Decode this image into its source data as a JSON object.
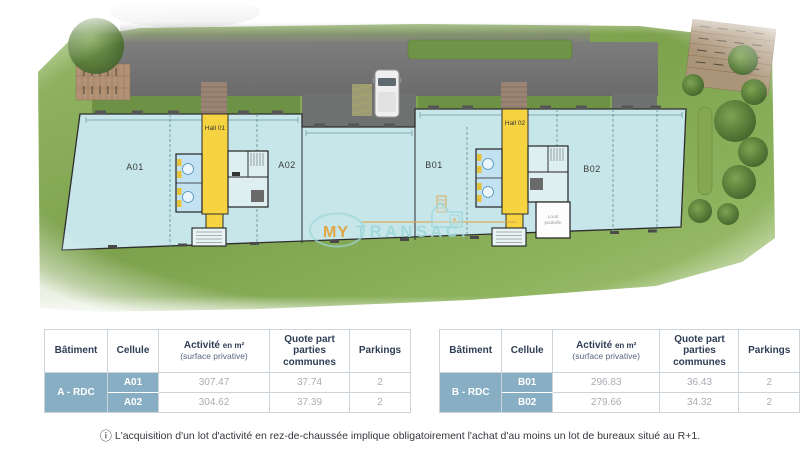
{
  "plan": {
    "cells": {
      "a01": "A01",
      "a02": "A02",
      "b01": "B01",
      "b02": "B02"
    },
    "halls": {
      "hall1": "Hall 01",
      "hall2": "Hall 02"
    },
    "local_room": {
      "line1": "Local",
      "line2": "poubelle"
    },
    "watermark": {
      "word1": "MY",
      "word2": "TRANSAC."
    },
    "colors": {
      "building_fill": "#c7e6e9",
      "hall_yellow": "#f6d340",
      "grass_green": "#86ab54",
      "road_gray": "#747576",
      "watermark_orange": "#e2a33c",
      "watermark_teal": "#9ed7da",
      "table_blue": "#88aec3"
    }
  },
  "tables": {
    "headers": {
      "batiment": "Bâtiment",
      "cellule": "Cellule",
      "activite": "Activité",
      "activite_unit": "en m²",
      "activite_sub": "(surface privative)",
      "quote": "Quote part parties communes",
      "parkings": "Parkings"
    },
    "a": {
      "batiment": "A - RDC",
      "rows": [
        [
          "A01",
          "307.47",
          "37.74",
          "2"
        ],
        [
          "A02",
          "304.62",
          "37.39",
          "2"
        ]
      ]
    },
    "b": {
      "batiment": "B - RDC",
      "rows": [
        [
          "B01",
          "296.83",
          "36.43",
          "2"
        ],
        [
          "B02",
          "279.66",
          "34.32",
          "2"
        ]
      ]
    }
  },
  "footnote": {
    "icon": "ⓘ",
    "text": "L'acquisition d'un lot d'activité en rez-de-chaussée implique obligatoirement l'achat d'au moins un lot de bureaux situé au R+1."
  }
}
